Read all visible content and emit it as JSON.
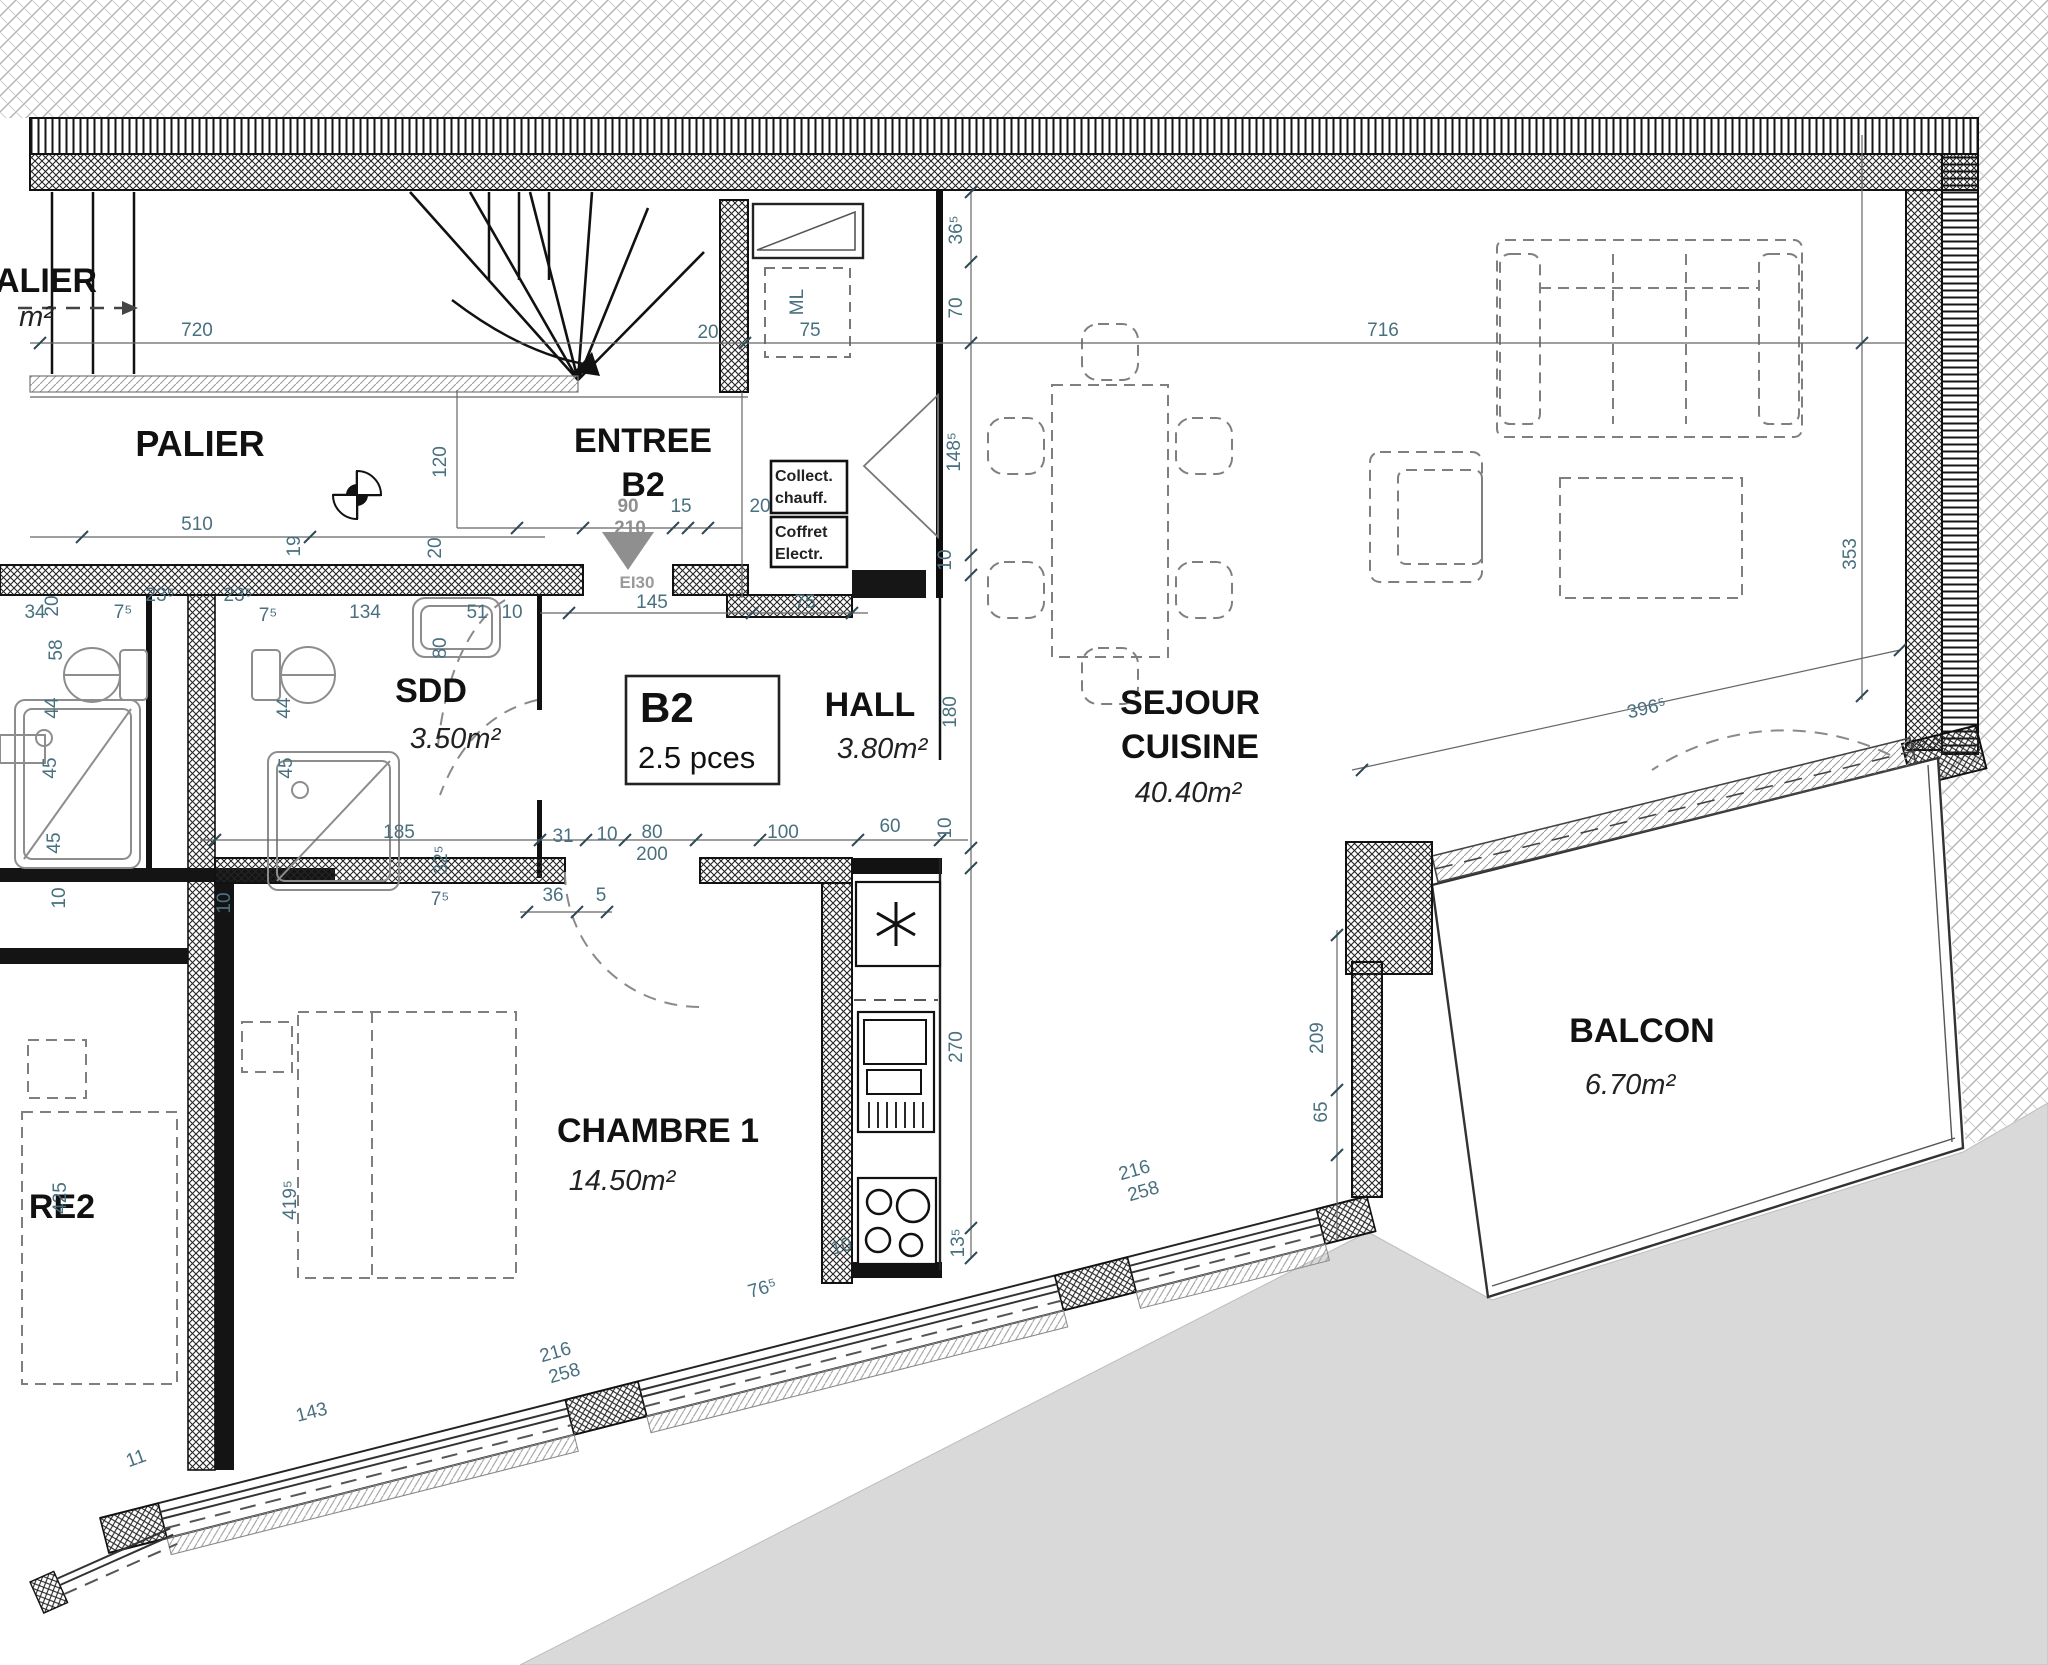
{
  "rooms": {
    "palier_cut": {
      "label": "ALIER",
      "area": "m²"
    },
    "palier": {
      "label": "PALIER"
    },
    "entree": {
      "line1": "ENTREE",
      "line2": "B2"
    },
    "sdd": {
      "label": "SDD",
      "area": "3.50m²"
    },
    "hall": {
      "label": "HALL",
      "area": "3.80m²"
    },
    "sejour": {
      "line1": "SEJOUR",
      "line2": "CUISINE",
      "area": "40.40m²"
    },
    "chambre1": {
      "label": "CHAMBRE 1",
      "area": "14.50m²"
    },
    "chambre2_cut": {
      "label": "RE2"
    },
    "balcon": {
      "label": "BALCON",
      "area": "6.70m²"
    }
  },
  "unit_box": {
    "id": "B2",
    "size": "2.5 pces"
  },
  "equipment": {
    "collect_line1": "Collect.",
    "collect_line2": "chauff.",
    "coffret_line1": "Coffret",
    "coffret_line2": "Electr.",
    "fire_rating": "EI30"
  },
  "colors": {
    "dim": "#49707f",
    "wall": "#1c1c1c",
    "ground": "#d9d9d9",
    "label": "#111111",
    "fixture": "#8d8d8d",
    "furniture": "#7f7f7f"
  },
  "dimensions": [
    {
      "t": "720",
      "x": 197,
      "y": 336
    },
    {
      "t": "716",
      "x": 1383,
      "y": 336
    },
    {
      "t": "20",
      "x": 708,
      "y": 338
    },
    {
      "t": "75",
      "x": 810,
      "y": 336
    },
    {
      "t": "ML",
      "x": 803,
      "y": 302,
      "r": -90
    },
    {
      "t": "36⁵",
      "x": 962,
      "y": 230,
      "r": -90
    },
    {
      "t": "70",
      "x": 962,
      "y": 308,
      "r": -90
    },
    {
      "t": "148⁵",
      "x": 960,
      "y": 452,
      "r": -90
    },
    {
      "t": "10",
      "x": 951,
      "y": 560,
      "r": -90
    },
    {
      "t": "180",
      "x": 956,
      "y": 712,
      "r": -90
    },
    {
      "t": "10",
      "x": 951,
      "y": 828,
      "r": -90
    },
    {
      "t": "270",
      "x": 962,
      "y": 1047,
      "r": -90
    },
    {
      "t": "13⁵",
      "x": 964,
      "y": 1243,
      "r": -90
    },
    {
      "t": "510",
      "x": 197,
      "y": 530
    },
    {
      "t": "19",
      "x": 300,
      "y": 546,
      "r": -90
    },
    {
      "t": "120",
      "x": 446,
      "y": 462,
      "r": -90
    },
    {
      "t": "20",
      "x": 441,
      "y": 548,
      "r": -90
    },
    {
      "t": "90",
      "x": 628,
      "y": 512,
      "c": "g"
    },
    {
      "t": "210",
      "x": 630,
      "y": 534,
      "c": "g"
    },
    {
      "t": "15",
      "x": 681,
      "y": 512
    },
    {
      "t": "20",
      "x": 760,
      "y": 512
    },
    {
      "t": "145",
      "x": 652,
      "y": 608
    },
    {
      "t": "75",
      "x": 805,
      "y": 608
    },
    {
      "t": "34",
      "x": 35,
      "y": 618
    },
    {
      "t": "7⁵",
      "x": 123,
      "y": 618
    },
    {
      "t": "23⁵",
      "x": 160,
      "y": 601
    },
    {
      "t": "23⁵",
      "x": 238,
      "y": 601
    },
    {
      "t": "7⁵",
      "x": 268,
      "y": 621
    },
    {
      "t": "134",
      "x": 365,
      "y": 618
    },
    {
      "t": "51",
      "x": 477,
      "y": 618
    },
    {
      "t": "10",
      "x": 512,
      "y": 618
    },
    {
      "t": "20",
      "x": 58,
      "y": 606,
      "r": -90
    },
    {
      "t": "58",
      "x": 62,
      "y": 650,
      "r": -90
    },
    {
      "t": "44",
      "x": 58,
      "y": 708,
      "r": -90
    },
    {
      "t": "45",
      "x": 56,
      "y": 768,
      "r": -90
    },
    {
      "t": "45",
      "x": 60,
      "y": 843,
      "r": -90
    },
    {
      "t": "44",
      "x": 290,
      "y": 708,
      "r": -90
    },
    {
      "t": "45",
      "x": 292,
      "y": 768,
      "r": -90
    },
    {
      "t": "80",
      "x": 446,
      "y": 648,
      "r": -90
    },
    {
      "t": "32⁵",
      "x": 447,
      "y": 860,
      "r": -90
    },
    {
      "t": "185",
      "x": 399,
      "y": 838
    },
    {
      "t": "31",
      "x": 563,
      "y": 842
    },
    {
      "t": "10",
      "x": 607,
      "y": 840
    },
    {
      "t": "80",
      "x": 652,
      "y": 838
    },
    {
      "t": "200",
      "x": 652,
      "y": 860
    },
    {
      "t": "100",
      "x": 783,
      "y": 838
    },
    {
      "t": "60",
      "x": 890,
      "y": 832
    },
    {
      "t": "36",
      "x": 553,
      "y": 901
    },
    {
      "t": "5",
      "x": 601,
      "y": 901
    },
    {
      "t": "7⁵",
      "x": 440,
      "y": 905
    },
    {
      "t": "10",
      "x": 65,
      "y": 898,
      "r": -90
    },
    {
      "t": "10",
      "x": 230,
      "y": 903,
      "r": -90
    },
    {
      "t": "425",
      "x": 66,
      "y": 1198,
      "r": -90
    },
    {
      "t": "419⁵",
      "x": 296,
      "y": 1200,
      "r": -90
    },
    {
      "t": "353",
      "x": 1856,
      "y": 554,
      "r": -90
    },
    {
      "t": "396⁵",
      "x": 1648,
      "y": 714,
      "r": -13
    },
    {
      "t": "209",
      "x": 1323,
      "y": 1038,
      "r": -90
    },
    {
      "t": "65",
      "x": 1327,
      "y": 1112,
      "r": -90
    },
    {
      "t": "216",
      "x": 1136,
      "y": 1176,
      "r": -16
    },
    {
      "t": "258",
      "x": 1145,
      "y": 1197,
      "r": -16
    },
    {
      "t": "216",
      "x": 557,
      "y": 1358,
      "r": -16
    },
    {
      "t": "258",
      "x": 566,
      "y": 1379,
      "r": -16
    },
    {
      "t": "76⁵",
      "x": 764,
      "y": 1294,
      "r": -16
    },
    {
      "t": "143",
      "x": 313,
      "y": 1418,
      "r": -14
    },
    {
      "t": "11",
      "x": 138,
      "y": 1464,
      "r": -20
    },
    {
      "t": "10",
      "x": 843,
      "y": 1252,
      "r": -16
    }
  ]
}
